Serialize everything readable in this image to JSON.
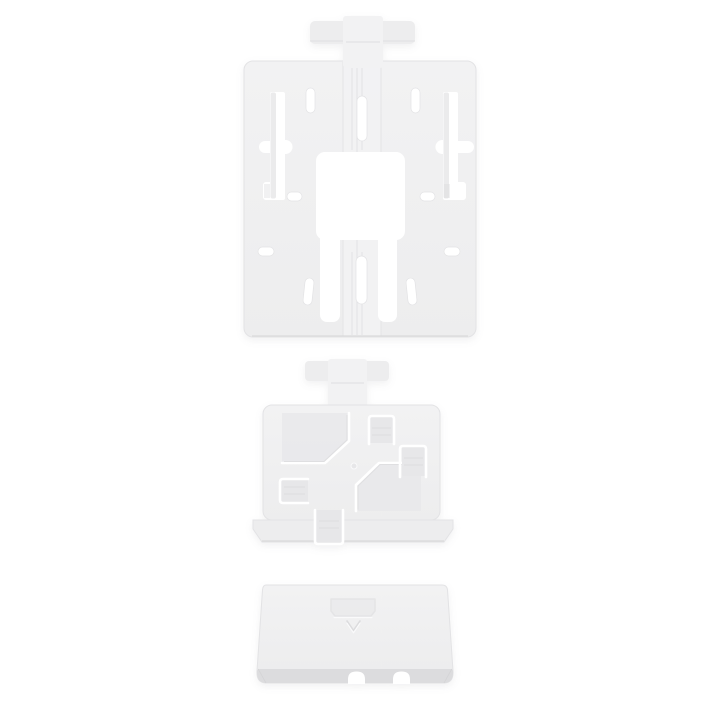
{
  "image": {
    "description": "Product photo on a white background: a three-piece white plastic mounting bracket kit arranged vertically - a flat mounting plate with keyhole slots and a central square cutout, a smaller locking adapter bracket with pinwheel clip grooves, and a small wedge-shaped cover with a down-arrow emboss and two notches."
  },
  "colors": {
    "background": "#ffffff",
    "plastic": "#ededee",
    "plastic_light": "#f2f2f3",
    "plastic_dark": "#e4e4e6",
    "recess": "#e7e7e9",
    "edge": "#e3e3e5",
    "groove": "#dfdfe1",
    "shadow": "#d8d8da",
    "bevel": "#dcdcde",
    "cutout": "#ffffff",
    "highlight": "#ffffff"
  },
  "parts": [
    {
      "id": "mounting-plate"
    },
    {
      "id": "lock-bracket"
    },
    {
      "id": "cover-wedge"
    }
  ]
}
